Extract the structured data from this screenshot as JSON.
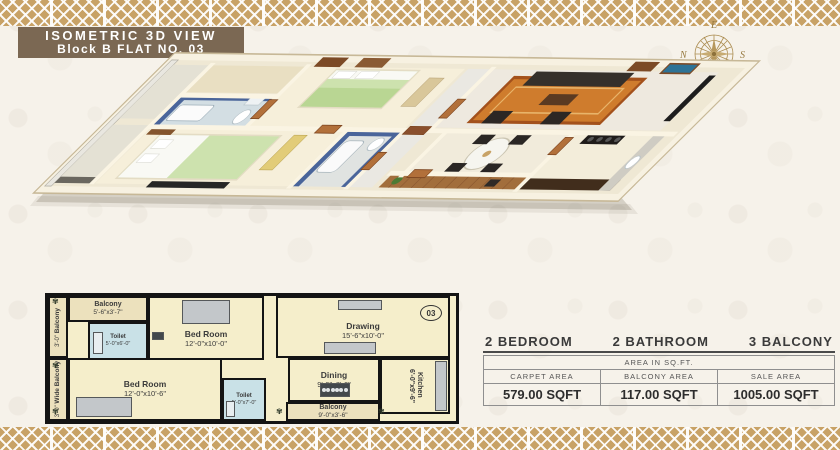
{
  "header": {
    "title_line1": "ISOMETRIC 3D VIEW",
    "title_line2": "Block B  FLAT NO. 03"
  },
  "compass": {
    "east": "E",
    "west": "W",
    "north": "N",
    "south": "S"
  },
  "colors": {
    "border_gold": "#c8a266",
    "title_bar_brown": "#7b6853",
    "plan_cream": "#f5eecb",
    "toilet_blue": "#c9e1e7",
    "balcony_tan": "#ece1bd",
    "bed_green": "#cde2ae",
    "rug_orange": "#cf7c2d"
  },
  "floor_plan_2d": {
    "unit_number": "03",
    "rooms": [
      {
        "id": "balcony-left-top",
        "label": "Balcony",
        "dims": "3'-0\""
      },
      {
        "id": "balcony-left-bottom",
        "label": "Wide Balcony",
        "dims": "3'-0\""
      },
      {
        "id": "balcony-top",
        "label": "Balcony",
        "dims": "5'-6\"x3'-7\""
      },
      {
        "id": "toilet-1",
        "label": "Toilet",
        "dims": "5'-0\"x6'-0\""
      },
      {
        "id": "bedroom-1",
        "label": "Bed Room",
        "dims": "12'-0\"x10'-0\""
      },
      {
        "id": "drawing",
        "label": "Drawing",
        "dims": "15'-6\"x10'-0\""
      },
      {
        "id": "bedroom-2",
        "label": "Bed Room",
        "dims": "12'-0\"x10'-6\""
      },
      {
        "id": "toilet-2",
        "label": "Toilet",
        "dims": "5'-0\"x7'-0\""
      },
      {
        "id": "dining",
        "label": "Dining",
        "dims": "9'-0\"x8'-0\""
      },
      {
        "id": "kitchen",
        "label": "Kitchen",
        "dims": "6'-0\"x9'-6\""
      },
      {
        "id": "balcony-bottom",
        "label": "Balcony",
        "dims": "9'-0\"x3'-6\""
      }
    ]
  },
  "summary": {
    "bedrooms": "2  BEDROOM",
    "bathrooms": "2  BATHROOM",
    "balconies": "3  BALCONY",
    "table": {
      "caption": "AREA IN SQ.FT.",
      "columns": [
        "CARPET AREA",
        "BALCONY AREA",
        "SALE AREA"
      ],
      "values": [
        "579.00 SQFT",
        "117.00 SQFT",
        "1005.00 SQFT"
      ]
    }
  }
}
